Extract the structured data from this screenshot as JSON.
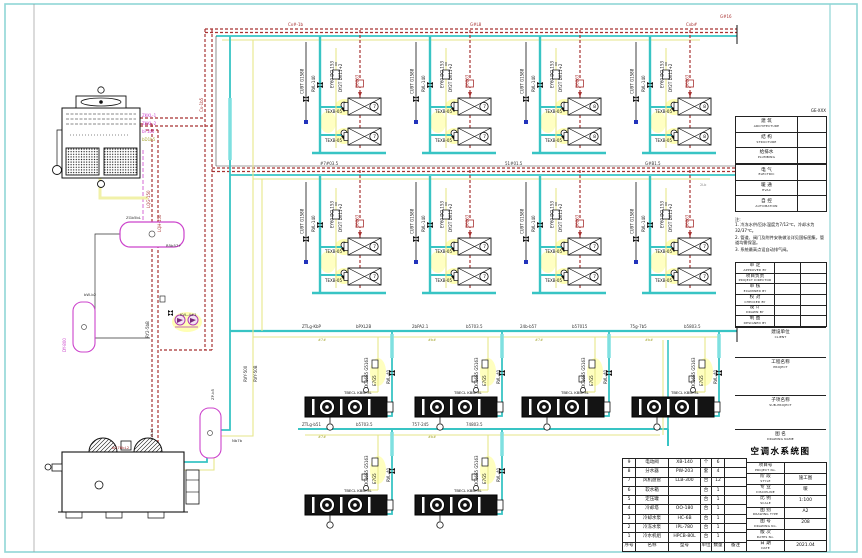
{
  "sheet": {
    "title": "空调水系统图"
  },
  "colors": {
    "pipe_chilled": "#38c4c4",
    "pipe_chilled_bright": "#7fe0e0",
    "pipe_hot": "#a83232",
    "pipe_condensate": "#e6e68a",
    "glow": "#ffffb4",
    "equipment_outline": "#cc44cc",
    "frame": "#8fd6d6",
    "line": "#1a1a1a"
  },
  "signoff": {
    "ref": "GE-XXX",
    "rows": [
      {
        "zh": "建 筑",
        "en": "ARCHITECTURE"
      },
      {
        "zh": "结 构",
        "en": "STRUCTURE"
      },
      {
        "zh": "给排水",
        "en": "PLUMBING"
      },
      {
        "zh": "",
        "en": ""
      },
      {
        "zh": "电 气",
        "en": "ELECTRIC"
      },
      {
        "zh": "暖 通",
        "en": "HVAC"
      },
      {
        "zh": "自 控",
        "en": "AUTOMATION"
      }
    ]
  },
  "notes": {
    "heading": "注:",
    "items": [
      "1. 冷冻水供/回水温度为7/12℃，冷却水为32/37℃。",
      "2. 管道、阀门及附件安装做法详见国标图集，管道均需保温。",
      "3. 系统最高点设自动排气阀。"
    ]
  },
  "review": {
    "rows": [
      {
        "zh": "审 定",
        "en": "APPROVED BY"
      },
      {
        "zh": "项目负责",
        "en": "PROJECT DIRECTOR"
      },
      {
        "zh": "审 核",
        "en": "EXAMINED BY"
      },
      {
        "zh": "校 对",
        "en": "CHECKED BY"
      },
      {
        "zh": "设 计",
        "en": "DRAWN BY"
      },
      {
        "zh": "制 图",
        "en": "DESIGNED BY"
      }
    ]
  },
  "client": {
    "zh": "建设单位",
    "en": "CLIENT"
  },
  "project": {
    "zh": "工程名称",
    "en": "PROJECT"
  },
  "subproject": {
    "zh": "子项名称",
    "en": "SUB-PROJECT"
  },
  "drawing_name": {
    "zh": "图 名",
    "en": "DRAWING NAME",
    "title": "空调水系统图"
  },
  "info_table": {
    "rows": [
      {
        "zh": "项目号",
        "en": "PROJECT No.",
        "val": ""
      },
      {
        "zh": "阶 段",
        "en": "STYLE",
        "val": "施工图"
      },
      {
        "zh": "专 业",
        "en": "DISCIPLINE",
        "val": "暖"
      },
      {
        "zh": "比 例",
        "en": "SCALE",
        "val": "1:100"
      },
      {
        "zh": "图 别",
        "en": "DRAWING TYPE",
        "val": "A2"
      },
      {
        "zh": "图 号",
        "en": "DRAWING No.",
        "val": "208"
      },
      {
        "zh": "版 次",
        "en": "DATES No.",
        "val": ""
      },
      {
        "zh": "日 期",
        "en": "DATE",
        "val": "2021.04"
      }
    ]
  },
  "equipment_table": {
    "headers": [
      "序号",
      "名称",
      "型号",
      "单位",
      "数量",
      "备注"
    ],
    "rows": [
      [
        "9",
        "电动阀",
        "XB-140",
        "个",
        "6",
        ""
      ],
      [
        "8",
        "分水器",
        "PW-203",
        "套",
        "4",
        ""
      ],
      [
        "7",
        "风机盘管",
        "LLB-300",
        "台",
        "12",
        ""
      ],
      [
        "6",
        "软水箱",
        "",
        "台",
        "1",
        ""
      ],
      [
        "5",
        "定压罐",
        "",
        "台",
        "1",
        ""
      ],
      [
        "4",
        "冷却塔",
        "OO-180",
        "台",
        "1",
        ""
      ],
      [
        "3",
        "冷却水泵",
        "HC-6B",
        "台",
        "1",
        ""
      ],
      [
        "2",
        "冷冻水泵",
        "IPL-780",
        "台",
        "1",
        ""
      ],
      [
        "1",
        "冷水机组",
        "HPCB-80L",
        "台",
        "1",
        ""
      ]
    ]
  },
  "symbols": {
    "unitA": {
      "l1": "CU9T G1588",
      "l2": "RVL-140",
      "l3": "EY60 DCL153",
      "l4": "DY2T DX11+2",
      "l5": "G6263",
      "box_label": "TEXB-05"
    },
    "unitB": {
      "l1": "DC16S5 G5163",
      "l2": "E7G5",
      "l3": "RVL-40",
      "box_label": "TBECL KBBY3L"
    }
  },
  "diagram": {
    "unit_instances": [
      {
        "sym": "unitA",
        "x": 298,
        "y": 36,
        "name": "ahu-branch-group"
      },
      {
        "sym": "unitA",
        "x": 408,
        "y": 36,
        "name": "ahu-branch-group"
      },
      {
        "sym": "unitA",
        "x": 518,
        "y": 36,
        "name": "ahu-branch-group"
      },
      {
        "sym": "unitA",
        "x": 628,
        "y": 36,
        "name": "ahu-branch-group"
      },
      {
        "sym": "unitA",
        "x": 298,
        "y": 176,
        "name": "ahu-branch-group"
      },
      {
        "sym": "unitA",
        "x": 408,
        "y": 176,
        "name": "ahu-branch-group"
      },
      {
        "sym": "unitA",
        "x": 518,
        "y": 176,
        "name": "ahu-branch-group"
      },
      {
        "sym": "unitA",
        "x": 628,
        "y": 176,
        "name": "ahu-branch-group"
      },
      {
        "sym": "unitB",
        "x": 300,
        "y": 342,
        "name": "fan-unit-group"
      },
      {
        "sym": "unitB",
        "x": 410,
        "y": 342,
        "name": "fan-unit-group"
      },
      {
        "sym": "unitB",
        "x": 517,
        "y": 342,
        "name": "fan-unit-group"
      },
      {
        "sym": "unitB",
        "x": 627,
        "y": 342,
        "name": "fan-unit-group"
      },
      {
        "sym": "unitB",
        "x": 300,
        "y": 440,
        "name": "fan-unit-group"
      },
      {
        "sym": "unitB",
        "x": 410,
        "y": 440,
        "name": "fan-unit-group"
      }
    ],
    "text_labels": [
      {
        "x": 374.5,
        "y": 108,
        "t": "7",
        "s": 4.5,
        "c": "#111",
        "a": "middle",
        "n": "unit-badge"
      },
      {
        "x": 374.5,
        "y": 138,
        "t": "7",
        "s": 4.5,
        "c": "#111",
        "a": "middle",
        "n": "unit-badge"
      },
      {
        "x": 484.5,
        "y": 108,
        "t": "7",
        "s": 4.5,
        "c": "#111",
        "a": "middle",
        "n": "unit-badge"
      },
      {
        "x": 484.5,
        "y": 138,
        "t": "7",
        "s": 4.5,
        "c": "#111",
        "a": "middle",
        "n": "unit-badge"
      },
      {
        "x": 594.5,
        "y": 108,
        "t": "8",
        "s": 4.5,
        "c": "#111",
        "a": "middle",
        "n": "unit-badge"
      },
      {
        "x": 594.5,
        "y": 138,
        "t": "8",
        "s": 4.5,
        "c": "#111",
        "a": "middle",
        "n": "unit-badge"
      },
      {
        "x": 704.5,
        "y": 108,
        "t": "8",
        "s": 4.5,
        "c": "#111",
        "a": "middle",
        "n": "unit-badge"
      },
      {
        "x": 704.5,
        "y": 138,
        "t": "8",
        "s": 4.5,
        "c": "#111",
        "a": "middle",
        "n": "unit-badge"
      },
      {
        "x": 374.5,
        "y": 248,
        "t": "7",
        "s": 4.5,
        "c": "#111",
        "a": "middle",
        "n": "unit-badge"
      },
      {
        "x": 374.5,
        "y": 278,
        "t": "7",
        "s": 4.5,
        "c": "#111",
        "a": "middle",
        "n": "unit-badge"
      },
      {
        "x": 484.5,
        "y": 248,
        "t": "7",
        "s": 4.5,
        "c": "#111",
        "a": "middle",
        "n": "unit-badge"
      },
      {
        "x": 484.5,
        "y": 278,
        "t": "7",
        "s": 4.5,
        "c": "#111",
        "a": "middle",
        "n": "unit-badge"
      },
      {
        "x": 594.5,
        "y": 248,
        "t": "7",
        "s": 4.5,
        "c": "#111",
        "a": "middle",
        "n": "unit-badge"
      },
      {
        "x": 594.5,
        "y": 278,
        "t": "7",
        "s": 4.5,
        "c": "#111",
        "a": "middle",
        "n": "unit-badge"
      },
      {
        "x": 704.5,
        "y": 248,
        "t": "7",
        "s": 4.5,
        "c": "#111",
        "a": "middle",
        "n": "unit-badge"
      },
      {
        "x": 704.5,
        "y": 278,
        "t": "7",
        "s": 4.5,
        "c": "#111",
        "a": "middle",
        "n": "unit-badge"
      },
      {
        "x": 288,
        "y": 26,
        "t": "Cx#-1b",
        "s": 4,
        "c": "#a83232",
        "n": "pipe-label"
      },
      {
        "x": 470,
        "y": 26,
        "t": "G#L8",
        "s": 4,
        "c": "#a83232",
        "n": "pipe-label"
      },
      {
        "x": 686,
        "y": 26,
        "t": "Cxb#",
        "s": 4,
        "c": "#a83232",
        "n": "pipe-label"
      },
      {
        "x": 720,
        "y": 18,
        "t": "G#16",
        "s": 4,
        "c": "#a83232",
        "n": "pipe-label"
      },
      {
        "x": 320,
        "y": 165,
        "t": "#7#03.5",
        "s": 4,
        "c": "#333",
        "n": "pipe-label"
      },
      {
        "x": 505,
        "y": 165,
        "t": "51#01.5",
        "s": 4,
        "c": "#333",
        "n": "pipe-label"
      },
      {
        "x": 645,
        "y": 165,
        "t": "G#B1.5",
        "s": 4,
        "c": "#333",
        "n": "pipe-label"
      },
      {
        "x": 700,
        "y": 186,
        "t": "2Lb",
        "s": 3.5,
        "c": "#888",
        "n": "pipe-label"
      },
      {
        "x": 302,
        "y": 328,
        "t": "ZTLg-KbP",
        "s": 4,
        "c": "#333",
        "n": "pipe-label"
      },
      {
        "x": 356,
        "y": 328,
        "t": "bPXL2B",
        "s": 4,
        "c": "#333",
        "n": "pipe-label"
      },
      {
        "x": 412,
        "y": 328,
        "t": "2bPA2.1",
        "s": 4,
        "c": "#333",
        "n": "pipe-label"
      },
      {
        "x": 466,
        "y": 328,
        "t": "b5703.5",
        "s": 4,
        "c": "#333",
        "n": "pipe-label"
      },
      {
        "x": 520,
        "y": 328,
        "t": "24b-b57",
        "s": 4,
        "c": "#333",
        "n": "pipe-label"
      },
      {
        "x": 572,
        "y": 328,
        "t": "b57015",
        "s": 4,
        "c": "#333",
        "n": "pipe-label"
      },
      {
        "x": 630,
        "y": 328,
        "t": "75g-7b5",
        "s": 4,
        "c": "#333",
        "n": "pipe-label"
      },
      {
        "x": 684,
        "y": 328,
        "t": "b5803.5",
        "s": 4,
        "c": "#333",
        "n": "pipe-label"
      },
      {
        "x": 318,
        "y": 341,
        "t": "#7#",
        "s": 3.5,
        "c": "#a8a832",
        "n": "pipe-label"
      },
      {
        "x": 428,
        "y": 341,
        "t": "#b#",
        "s": 3.5,
        "c": "#a8a832",
        "n": "pipe-label"
      },
      {
        "x": 535,
        "y": 341,
        "t": "#7#",
        "s": 3.5,
        "c": "#a8a832",
        "n": "pipe-label"
      },
      {
        "x": 645,
        "y": 341,
        "t": "#b#",
        "s": 3.5,
        "c": "#a8a832",
        "n": "pipe-label"
      },
      {
        "x": 302,
        "y": 426,
        "t": "ZTLg-b51",
        "s": 4,
        "c": "#333",
        "n": "pipe-label"
      },
      {
        "x": 356,
        "y": 426,
        "t": "b5703.5",
        "s": 4,
        "c": "#333",
        "n": "pipe-label"
      },
      {
        "x": 412,
        "y": 426,
        "t": "757-245",
        "s": 4,
        "c": "#333",
        "n": "pipe-label"
      },
      {
        "x": 466,
        "y": 426,
        "t": "74803.5",
        "s": 4,
        "c": "#333",
        "n": "pipe-label"
      },
      {
        "x": 318,
        "y": 438,
        "t": "#7#",
        "s": 3.5,
        "c": "#a8a832",
        "n": "pipe-label"
      },
      {
        "x": 428,
        "y": 438,
        "t": "#b#",
        "s": 3.5,
        "c": "#a8a832",
        "n": "pipe-label"
      },
      {
        "x": 142,
        "y": 117,
        "t": "ZKKL-1",
        "s": 4,
        "c": "#cc44cc",
        "n": "tower-label"
      },
      {
        "x": 142,
        "y": 125,
        "t": "ZKKL-2",
        "s": 4,
        "c": "#cc44cc",
        "n": "tower-label"
      },
      {
        "x": 142,
        "y": 133,
        "t": "bF1b5",
        "s": 4,
        "c": "#cc44cc",
        "n": "tower-label"
      },
      {
        "x": 142,
        "y": 141,
        "t": "bD1b5",
        "s": 4,
        "c": "#a8a832",
        "n": "tower-label"
      },
      {
        "x": 203,
        "y": 112,
        "t": "Cx-1b5",
        "s": 4,
        "c": "#a83232",
        "r": -90,
        "n": "pipe-label"
      },
      {
        "x": 150,
        "y": 208,
        "t": "LQG-150",
        "s": 4,
        "c": "#a83232",
        "r": -90,
        "n": "pipe-label"
      },
      {
        "x": 161,
        "y": 232,
        "t": "LQH-150",
        "s": 4,
        "c": "#a83232",
        "r": -90,
        "n": "pipe-label"
      },
      {
        "x": 149,
        "y": 338,
        "t": "RY2-5bB",
        "s": 4,
        "c": "#333",
        "r": -90,
        "n": "pipe-label"
      },
      {
        "x": 247,
        "y": 382,
        "t": "RVY-500",
        "s": 4,
        "c": "#333",
        "r": -90,
        "n": "pipe-label"
      },
      {
        "x": 257,
        "y": 382,
        "t": "RVY-50B",
        "s": 4,
        "c": "#333",
        "r": -90,
        "n": "pipe-label"
      },
      {
        "x": 66,
        "y": 352,
        "t": "DY-800",
        "s": 4,
        "c": "#cc44cc",
        "r": -90,
        "n": "tank-label"
      },
      {
        "x": 153,
        "y": 440,
        "t": "KVLb1",
        "s": 3.8,
        "c": "#333",
        "r": -90,
        "n": "pipe-label"
      },
      {
        "x": 214,
        "y": 400,
        "t": "ZP-b5",
        "s": 3.8,
        "c": "#333",
        "r": -90,
        "n": "tank-label"
      },
      {
        "x": 126,
        "y": 219,
        "t": "ZGb5bL",
        "s": 3.8,
        "c": "#333",
        "n": "tank-label"
      },
      {
        "x": 166,
        "y": 247,
        "t": "R5b57+",
        "s": 3.8,
        "c": "#333",
        "n": "tank-label"
      },
      {
        "x": 84,
        "y": 296,
        "t": "bW-b2",
        "s": 3.8,
        "c": "#333",
        "n": "tank-label"
      },
      {
        "x": 112,
        "y": 449,
        "t": "bG78bL2",
        "s": 3.8,
        "c": "#a83232",
        "n": "chiller-label"
      },
      {
        "x": 232,
        "y": 442,
        "t": "Nb7b",
        "s": 3.8,
        "c": "#333",
        "n": "pipe-label"
      },
      {
        "x": 180,
        "y": 316,
        "t": "KVL-4#1",
        "s": 3.8,
        "c": "#333",
        "n": "pump-label"
      }
    ]
  }
}
